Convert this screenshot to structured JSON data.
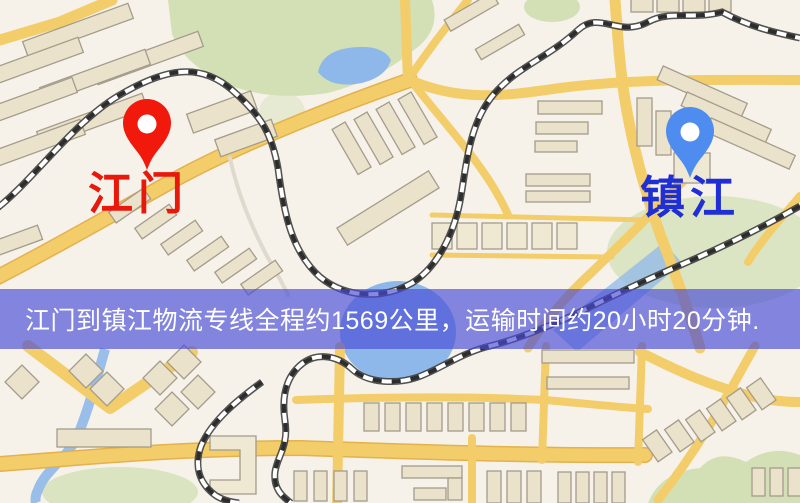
{
  "map": {
    "background_color": "#f6f2ea",
    "road_color": "#f3cd6a",
    "water_color": "#8fb8ea",
    "park_color": "#d3e0b5",
    "building_color": "#eae2ca",
    "railway_color": "#2d2d2d"
  },
  "markers": {
    "origin": {
      "label": "江门",
      "pin_color": "#f0190c",
      "label_color": "#e8180a"
    },
    "destination": {
      "label": "镇江",
      "pin_color": "#4e8cf0",
      "label_color": "#1f2fd4"
    }
  },
  "banner": {
    "text": "江门到镇江物流专线全程约1569公里，运输时间约20小时20分钟.",
    "background_color": "#4b4ed8",
    "text_color": "#ffffff",
    "origin": "江门",
    "destination": "镇江",
    "distance_km": "1569",
    "duration": "20小时20分钟"
  }
}
